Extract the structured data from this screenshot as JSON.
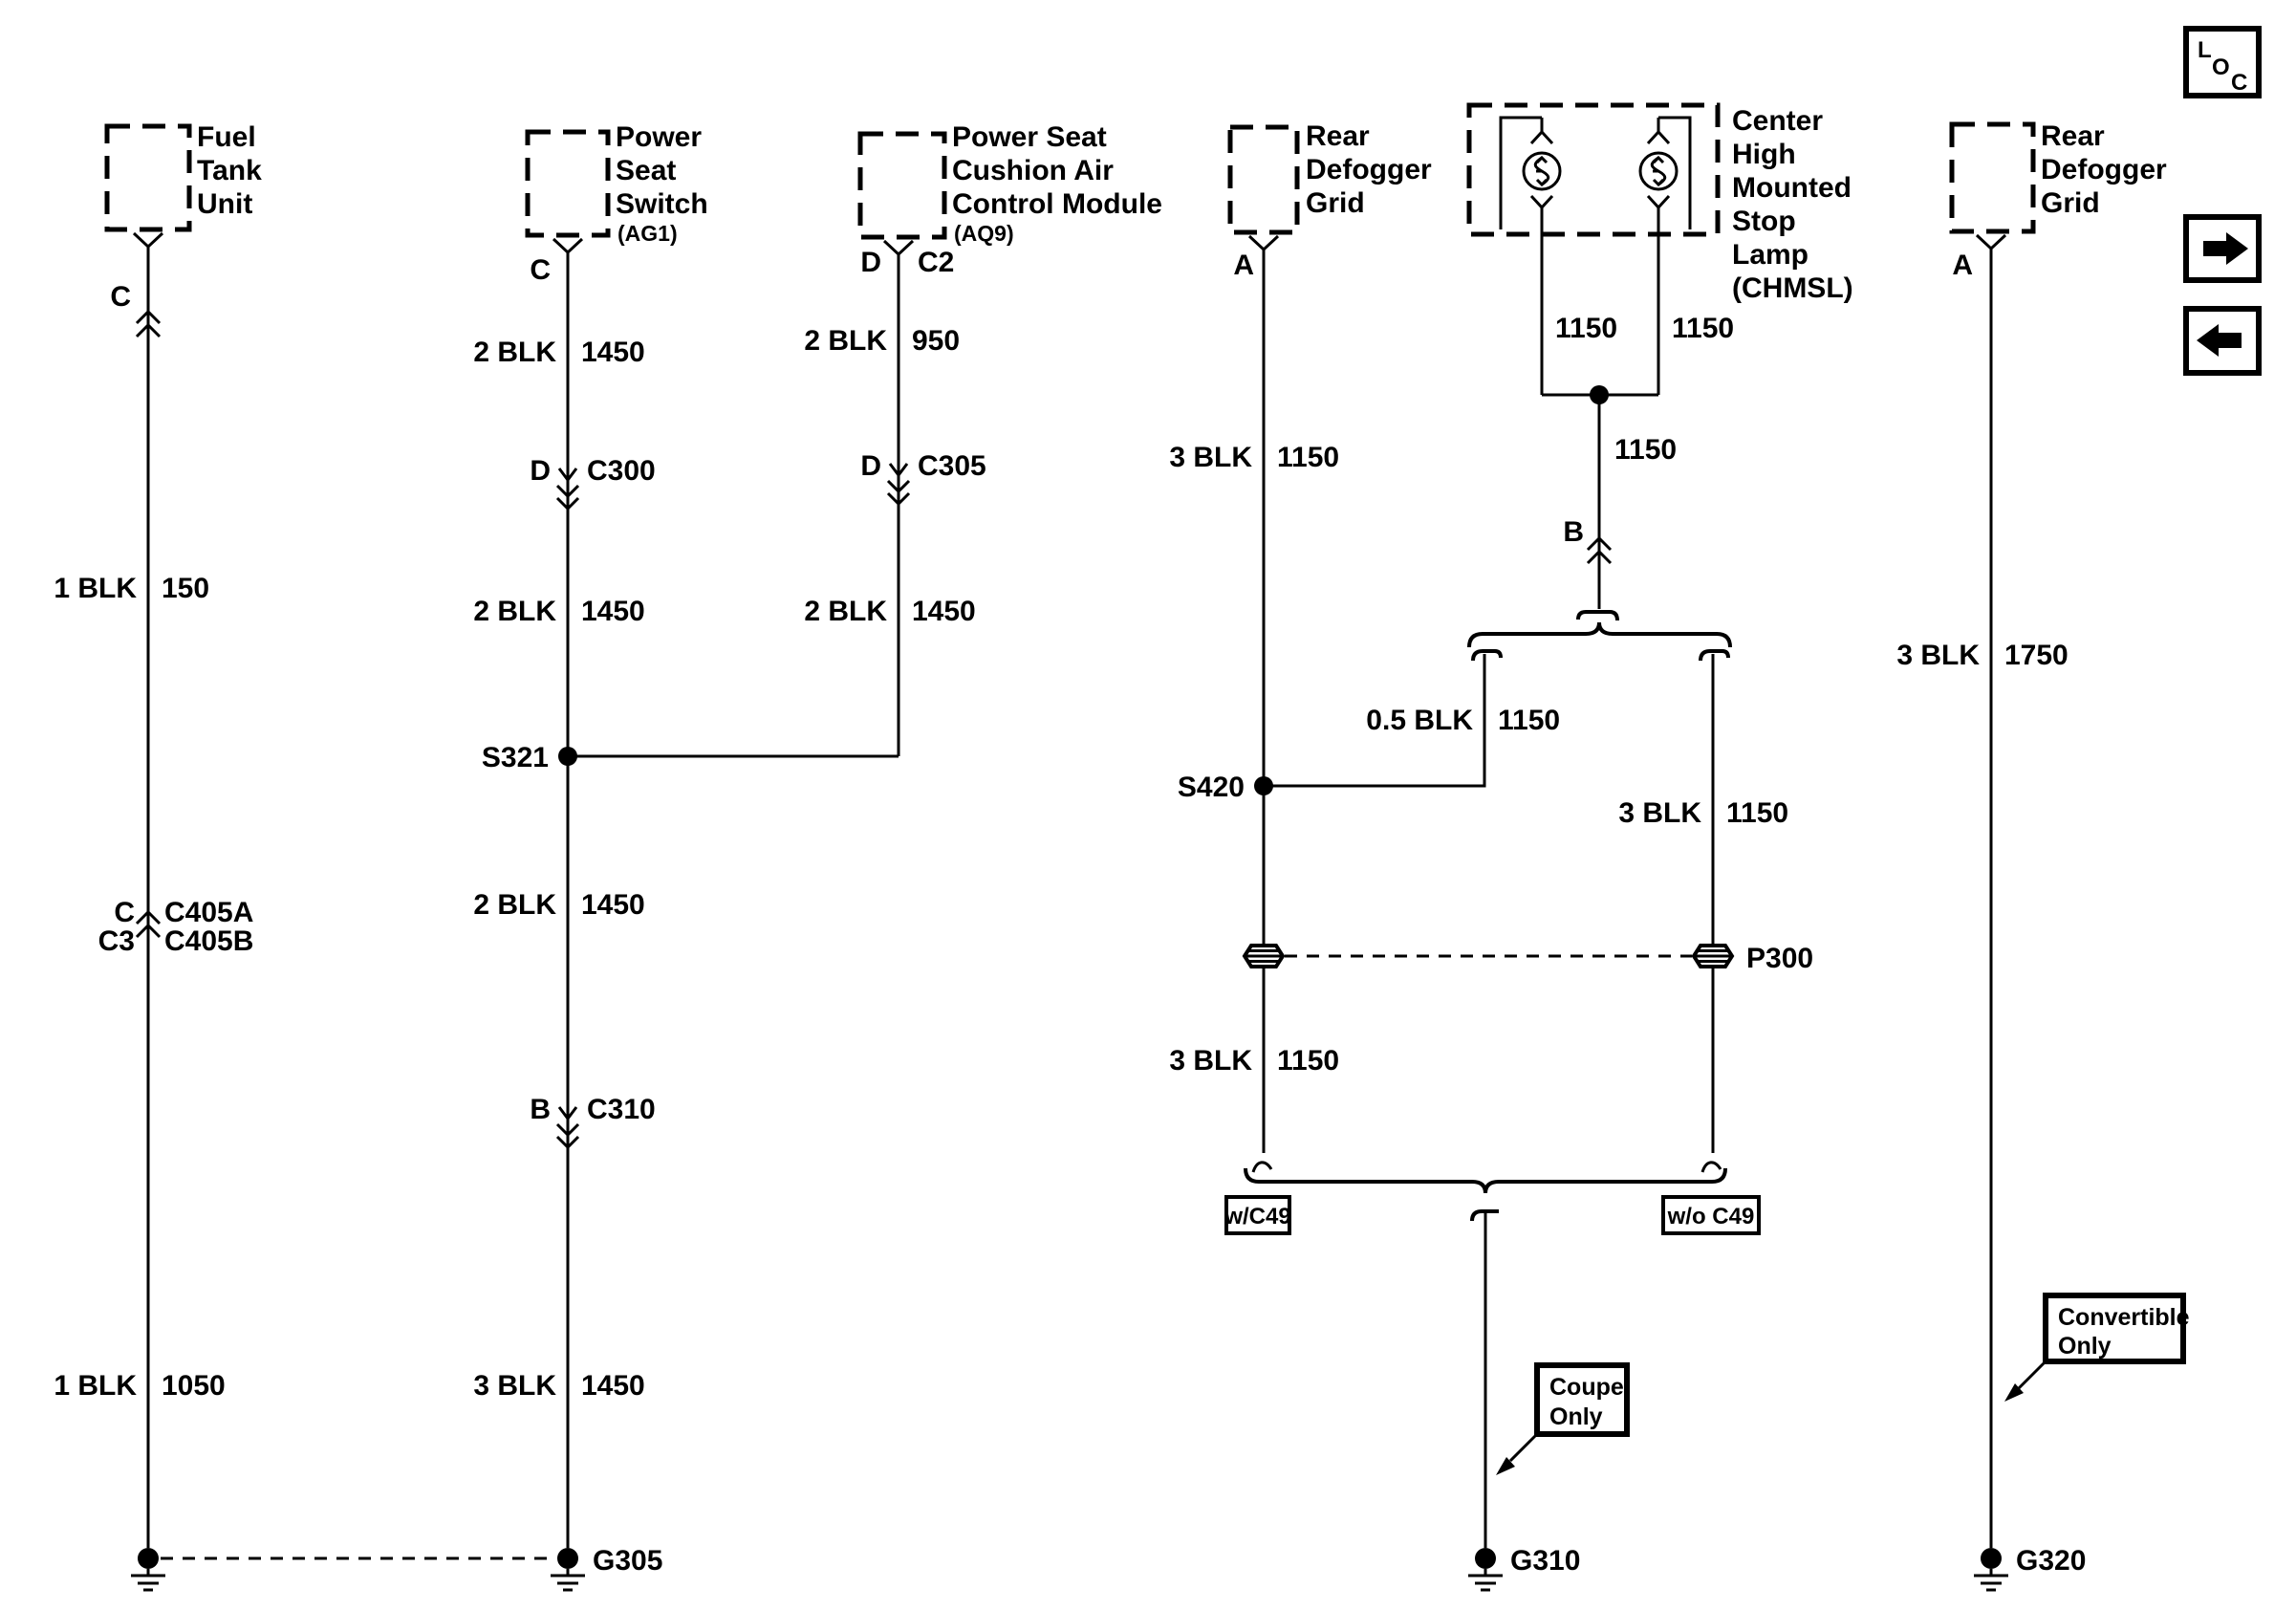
{
  "nav": {
    "loc": {
      "l": "L",
      "o": "O",
      "c": "C"
    }
  },
  "fuel_tank": {
    "name": [
      "Fuel",
      "Tank",
      "Unit"
    ],
    "pin": "C",
    "wire_upper": {
      "gauge": "1 BLK",
      "circuit": "150"
    },
    "connector": {
      "pin_top": "C",
      "id_top": "C405A",
      "pin_bottom": "C3",
      "id_bottom": "C405B"
    },
    "wire_lower": {
      "gauge": "1 BLK",
      "circuit": "1050"
    }
  },
  "seat_switch": {
    "name": [
      "Power",
      "Seat",
      "Switch"
    ],
    "sub": "(AG1)",
    "pin": "C",
    "wire1": {
      "gauge": "2 BLK",
      "circuit": "1450"
    },
    "conn1": {
      "pin": "D",
      "id": "C300"
    },
    "wire2": {
      "gauge": "2 BLK",
      "circuit": "1450"
    },
    "splice": "S321",
    "wire3": {
      "gauge": "2 BLK",
      "circuit": "1450"
    },
    "conn2": {
      "pin": "B",
      "id": "C310"
    },
    "wire4": {
      "gauge": "3 BLK",
      "circuit": "1450"
    },
    "ground": "G305"
  },
  "cushion_module": {
    "name": [
      "Power Seat",
      "Cushion Air",
      "Control Module"
    ],
    "sub": "(AQ9)",
    "pin": "D",
    "conn_top": "C2",
    "wire1": {
      "gauge": "2 BLK",
      "circuit": "950"
    },
    "conn1": {
      "pin": "D",
      "id": "C305"
    },
    "wire2": {
      "gauge": "2 BLK",
      "circuit": "1450"
    }
  },
  "defogger_left": {
    "name": [
      "Rear",
      "Defogger",
      "Grid"
    ],
    "pin": "A",
    "wire1": {
      "gauge": "3 BLK",
      "circuit": "1150"
    },
    "splice": "S420",
    "wire2": {
      "gauge": "3 BLK",
      "circuit": "1150"
    },
    "ground": "G310"
  },
  "chmsl": {
    "name": [
      "Center",
      "High",
      "Mounted",
      "Stop",
      "Lamp",
      "(CHMSL)"
    ],
    "lamp_left_circuit": "1150",
    "lamp_right_circuit": "1150",
    "joined_circuit": "1150",
    "pin": "B",
    "branch_left": {
      "gauge": "0.5 BLK",
      "circuit": "1150"
    },
    "branch_right": {
      "gauge": "3 BLK",
      "circuit": "1150"
    },
    "pass_through": "P300",
    "option_left": "w/C49",
    "option_right": "w/o C49",
    "note": [
      "Coupe",
      "Only"
    ]
  },
  "defogger_right": {
    "name": [
      "Rear",
      "Defogger",
      "Grid"
    ],
    "pin": "A",
    "wire1": {
      "gauge": "3 BLK",
      "circuit": "1750"
    },
    "ground": "G320",
    "note": [
      "Convertible",
      "Only"
    ]
  }
}
